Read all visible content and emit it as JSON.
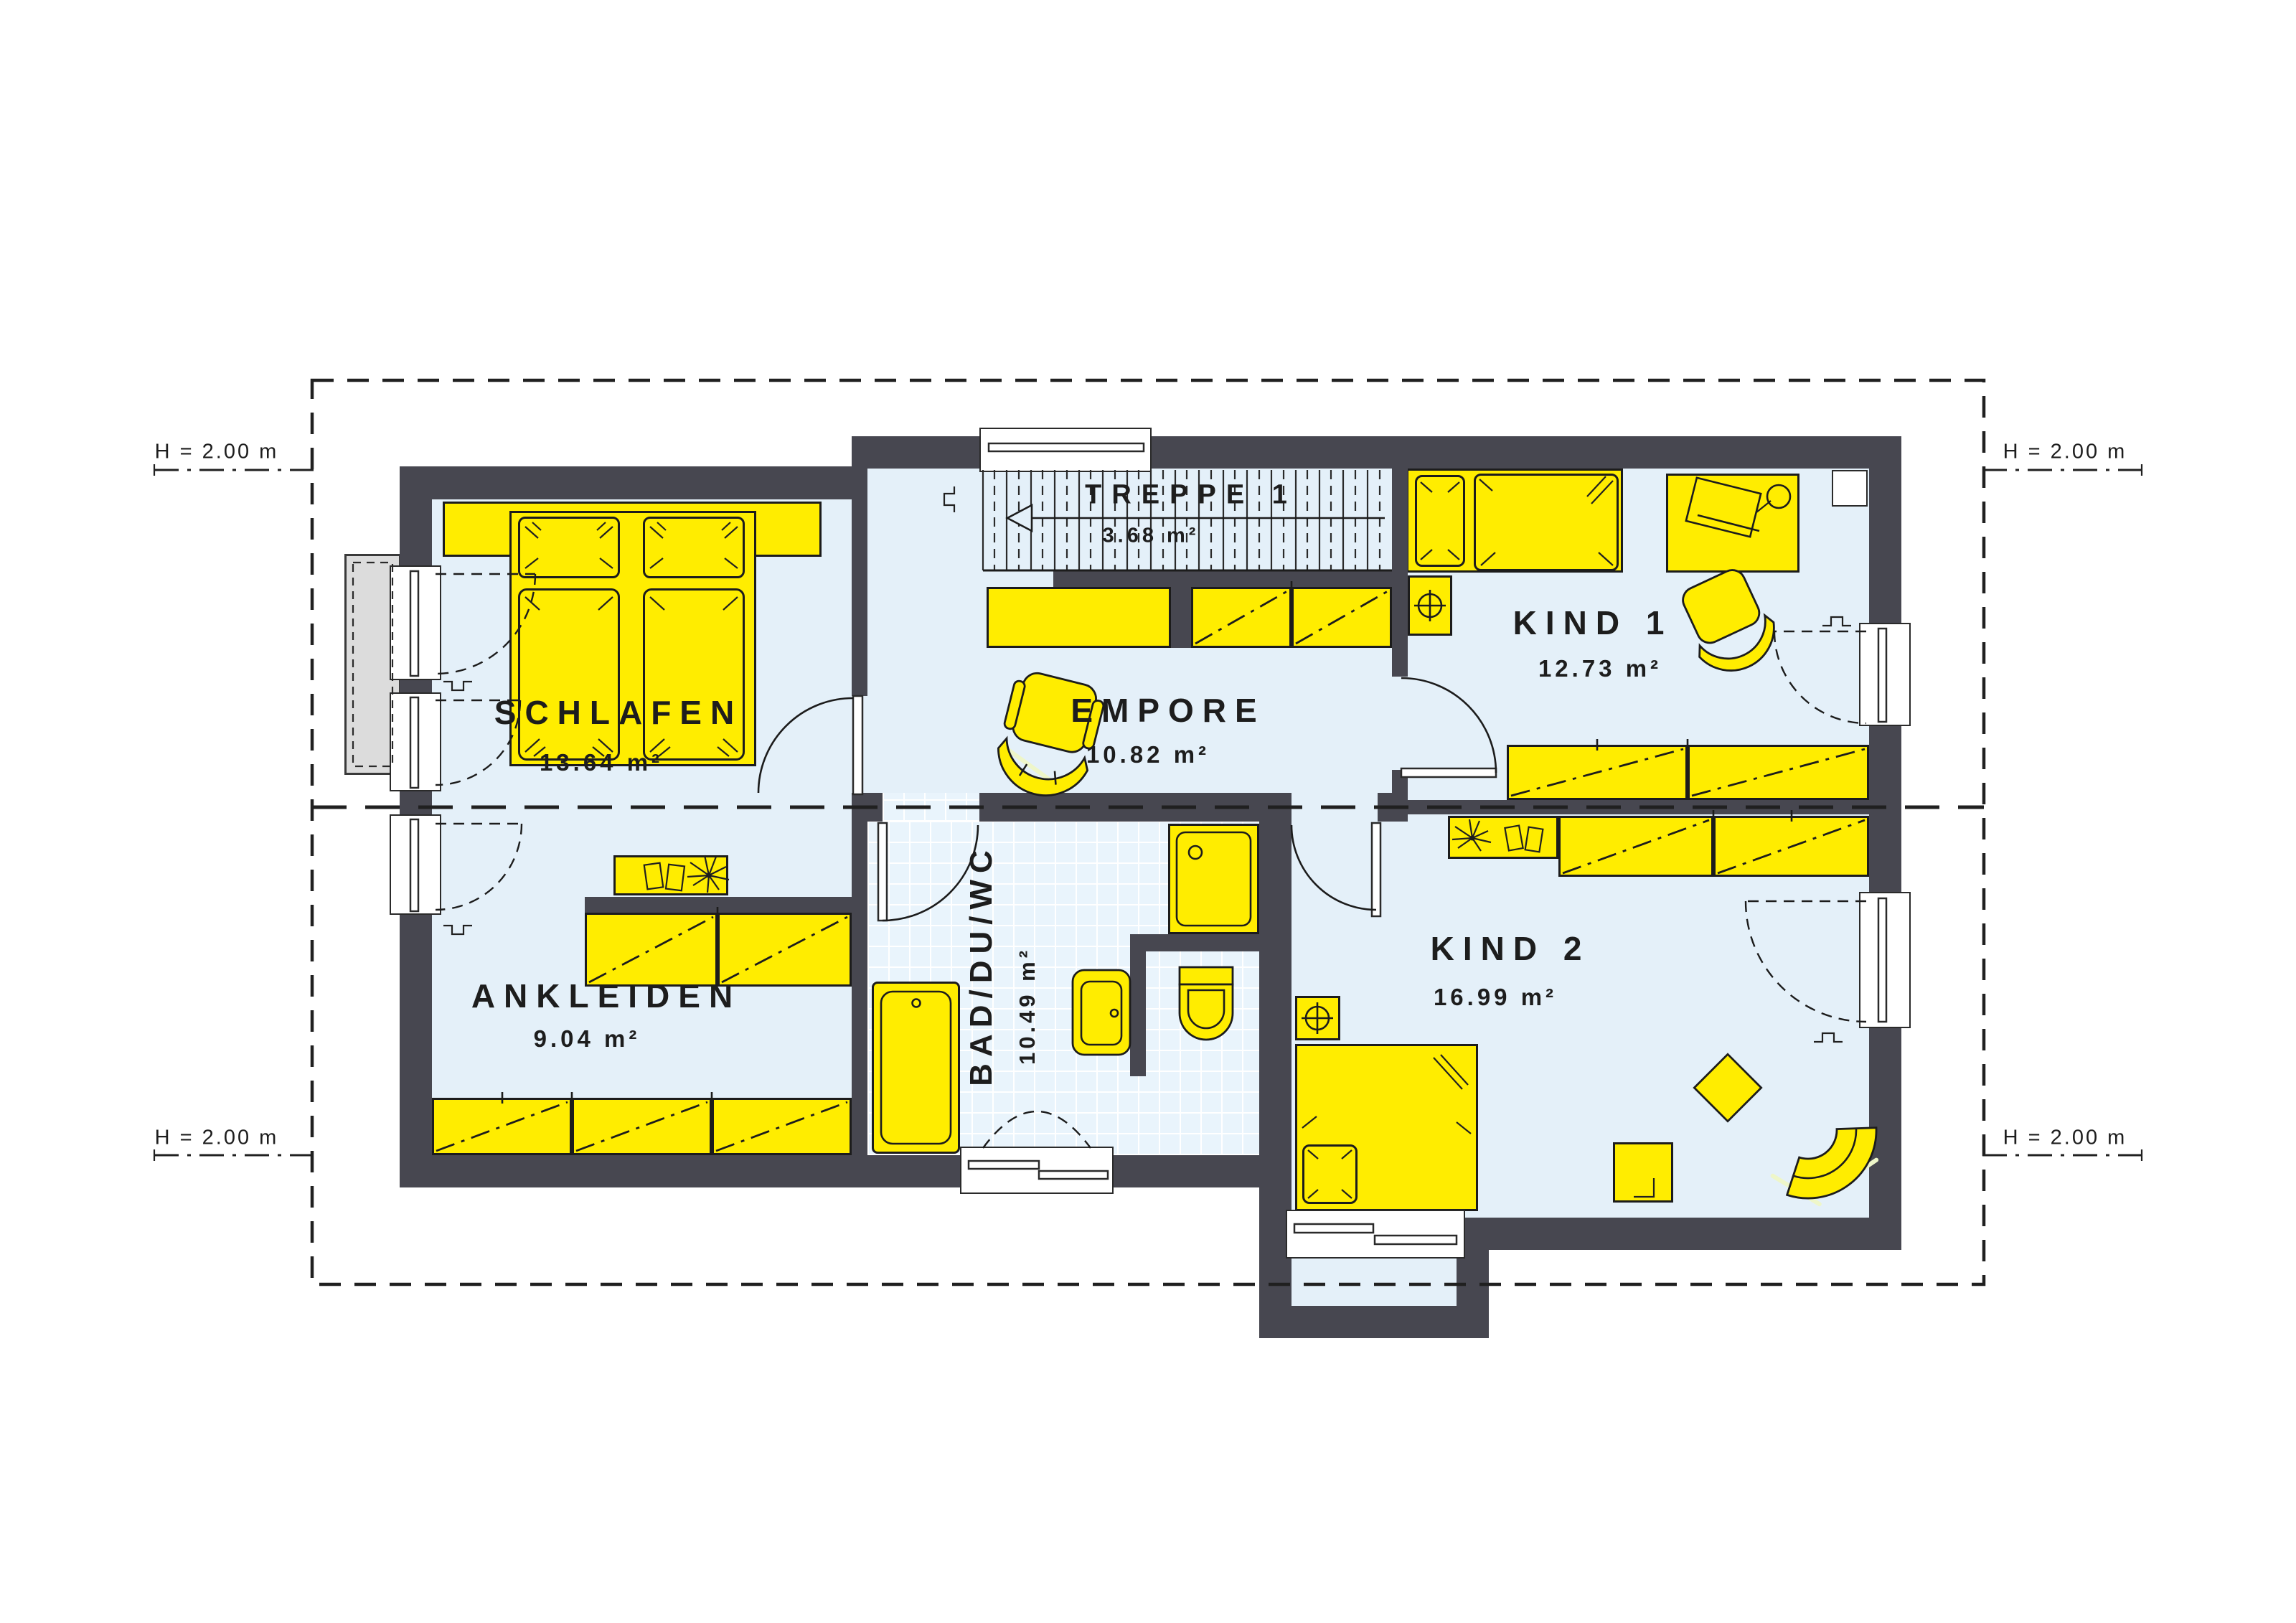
{
  "plan": {
    "title": "Dachgeschoss Grundriss",
    "height_marker": "H = 2.00 m",
    "rooms": [
      {
        "id": "schlafen",
        "name": "SCHLAFEN",
        "area": "13.64 m²"
      },
      {
        "id": "treppe",
        "name": "TREPPE 1",
        "area": "3.68 m²"
      },
      {
        "id": "empore",
        "name": "EMPORE",
        "area": "10.82 m²"
      },
      {
        "id": "kind1",
        "name": "KIND 1",
        "area": "12.73 m²"
      },
      {
        "id": "ankleiden",
        "name": "ANKLEIDEN",
        "area": "9.04 m²"
      },
      {
        "id": "bad",
        "name": "BAD/DU/WC",
        "area": "10.49 m²"
      },
      {
        "id": "kind2",
        "name": "KIND 2",
        "area": "16.99 m²"
      }
    ],
    "colors": {
      "furniture": "#ffed00",
      "wall": "#474750",
      "floor": "#e4f0f9",
      "tile": "#e9f4fc",
      "balcony": "#dcdcdc",
      "line": "#1c1c1c"
    }
  }
}
